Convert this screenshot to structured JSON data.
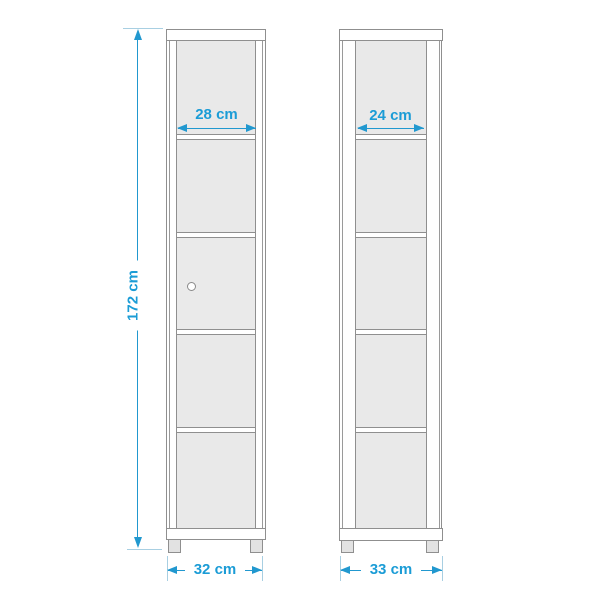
{
  "accent_color": "#1b9cd6",
  "line_color": "#2198cf",
  "outline_color": "#8f8f8f",
  "interior_color": "#e9e9e9",
  "dimensions": {
    "height": "172 cm",
    "front_inner_width": "28 cm",
    "front_outer_width": "32 cm",
    "side_inner_width": "24 cm",
    "side_outer_width": "33 cm"
  }
}
